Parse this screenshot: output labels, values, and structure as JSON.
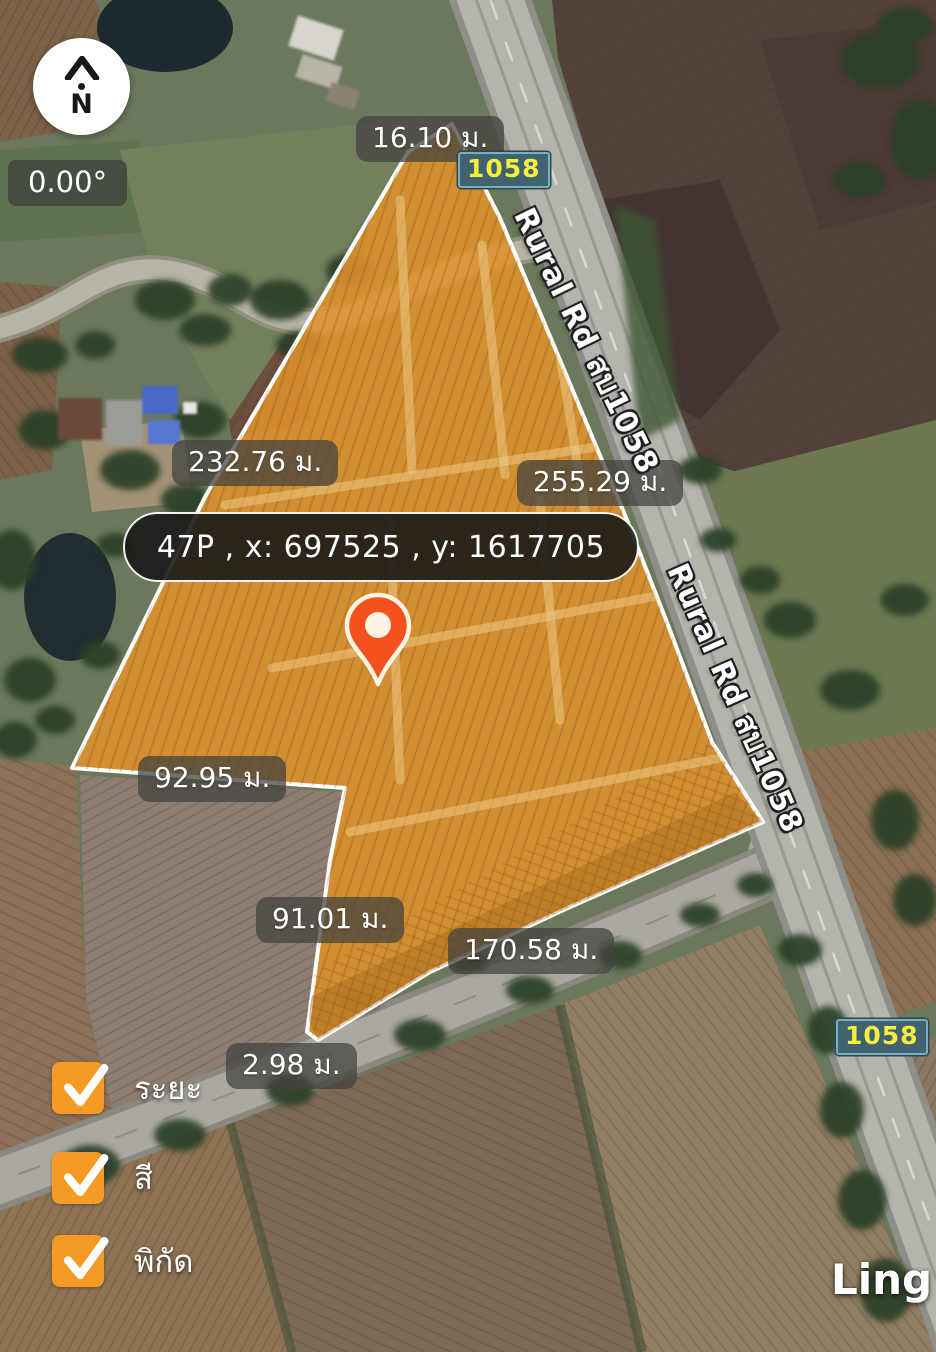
{
  "compass": {
    "north_label": "N",
    "bearing": "0.00°"
  },
  "parcel": {
    "coordinate": "47P , x: 697525 , y: 1617705",
    "measurements": [
      {
        "edge": "top",
        "text": "16.10 ม."
      },
      {
        "edge": "upper-left",
        "text": "232.76 ม."
      },
      {
        "edge": "upper-right",
        "text": "255.29 ม."
      },
      {
        "edge": "mid-left",
        "text": "92.95 ม."
      },
      {
        "edge": "lower-left",
        "text": "91.01 ม."
      },
      {
        "edge": "bottom-right",
        "text": "170.58 ม."
      },
      {
        "edge": "bottom-tiny",
        "text": "2.98 ม."
      }
    ]
  },
  "map": {
    "road_shield": "1058",
    "road_name": "Rural Rd สบ1058",
    "place_label": "Ling"
  },
  "legend": {
    "items": [
      {
        "label": "ระยะ",
        "checked": true
      },
      {
        "label": "สี",
        "checked": true
      },
      {
        "label": "พิกัด",
        "checked": true
      }
    ]
  },
  "colors": {
    "parcel_fill": "#DC9134",
    "parcel_outline": "#FFFFFF",
    "pin": "#F4511E",
    "checkbox_accent": "#F59B25",
    "shield_bg": "#41626F",
    "shield_text": "#F5EE3E"
  }
}
